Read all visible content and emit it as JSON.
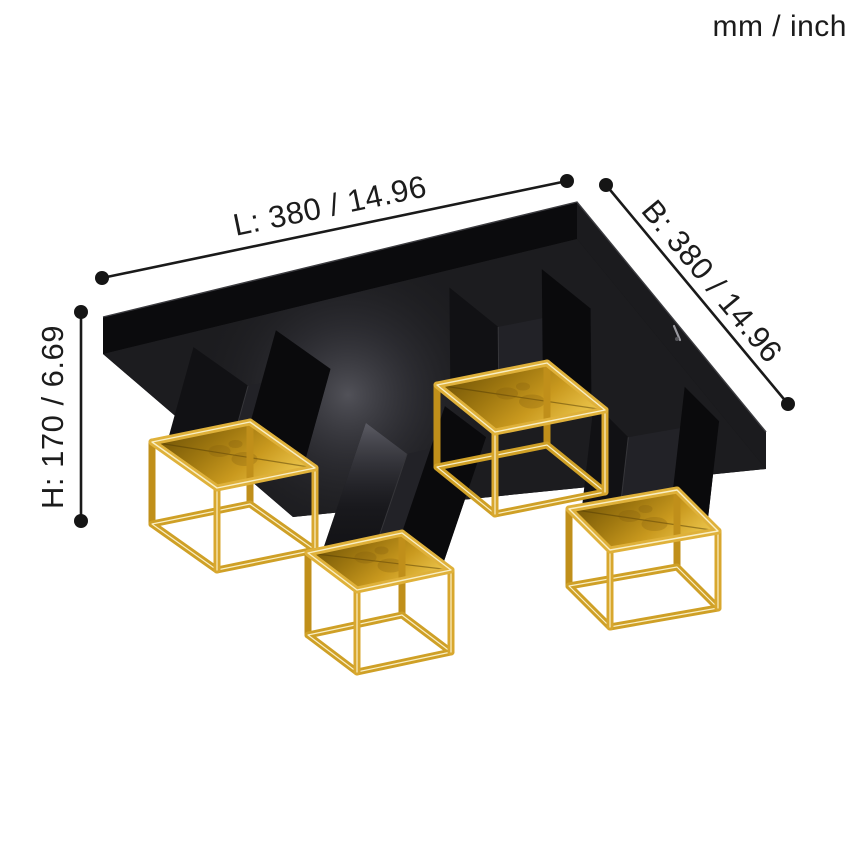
{
  "units_label": "mm / inch",
  "dimensions": {
    "length": {
      "label": "L: 380 / 14.96"
    },
    "width": {
      "label": "B: 380 / 14.96"
    },
    "height": {
      "label": "H: 170 / 6.69"
    }
  },
  "illustration": {
    "description": "Black square ceiling canopy with four black cube stems, each ending in an open gold wireframe cube shade with a gold-leaf inner top panel",
    "colors": {
      "background": "#ffffff",
      "dimension_line": "#1a1a1a",
      "dimension_text": "#1c1c1c",
      "plate_black": "#141416",
      "plate_underside": "#1c1c1f",
      "plate_side_left": "#0b0b0d",
      "plate_side_right": "#1b1b1e",
      "plate_edge_highlight": "#3c3c40",
      "stem_front": "#222227",
      "stem_left": "#111114",
      "stem_right": "#0a0a0c",
      "sheen_gray": "#7d7d87",
      "gold_frame": "#d8a72e",
      "gold_frame_light": "#dfb13a",
      "gold_frame_dark": "#c08f1a",
      "gold_frame_bottom": "#cfa026",
      "gold_glow": "#f9efc6",
      "leaf_dark": "#6e5206",
      "leaf_mid": "#c9991e",
      "leaf_bright": "#edc84f",
      "screw_gray": "#9a9aa0"
    }
  }
}
